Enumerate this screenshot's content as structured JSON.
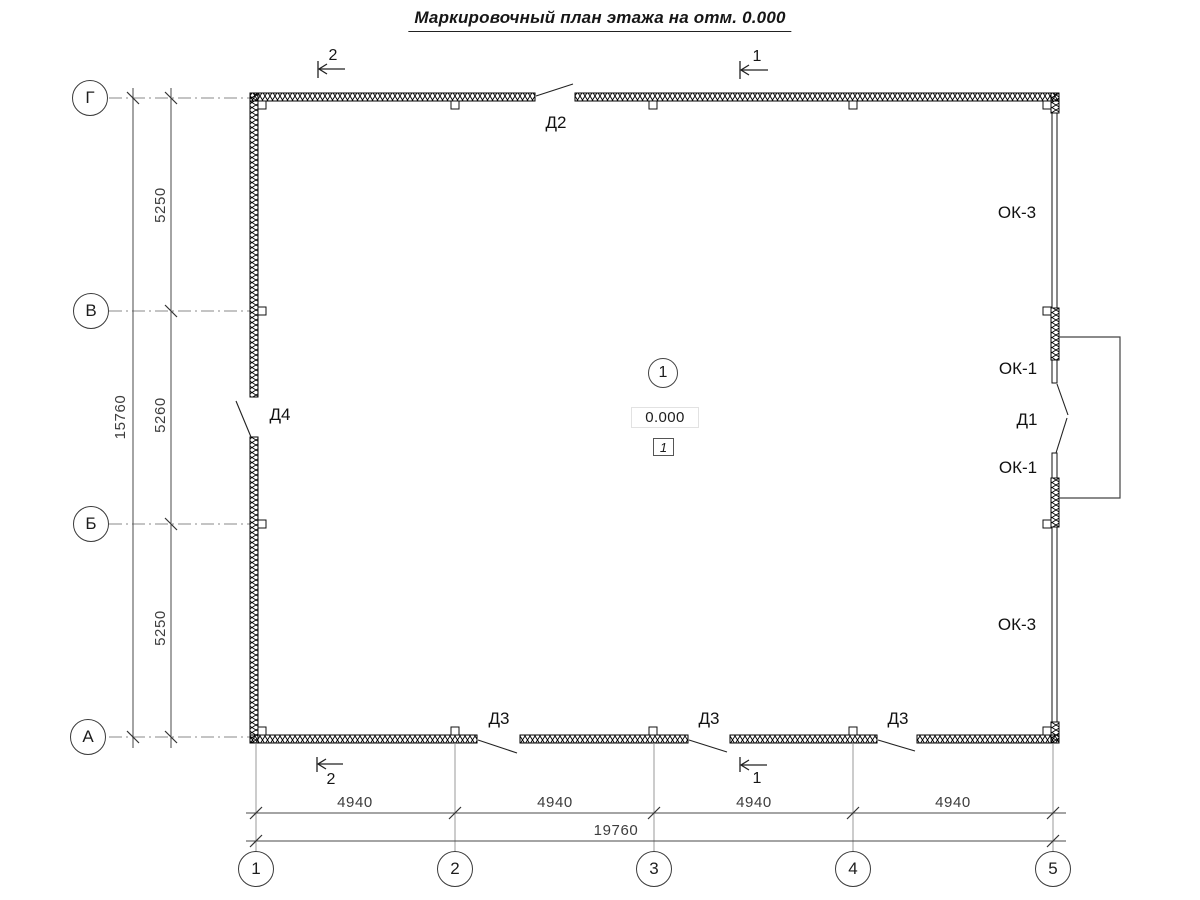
{
  "title": "Маркировочный план этажа на отм. 0.000",
  "room_marker": {
    "number": "1",
    "elevation": "0.000",
    "zone": "1"
  },
  "axes": {
    "rows": [
      {
        "label": "Г"
      },
      {
        "label": "В"
      },
      {
        "label": "Б"
      },
      {
        "label": "А"
      }
    ],
    "cols": [
      {
        "label": "1"
      },
      {
        "label": "2"
      },
      {
        "label": "3"
      },
      {
        "label": "4"
      },
      {
        "label": "5"
      }
    ]
  },
  "dimensions": {
    "vertical": {
      "segments": [
        "5250",
        "5260",
        "5250"
      ],
      "total": "15760"
    },
    "horizontal": {
      "segments": [
        "4940",
        "4940",
        "4940",
        "4940"
      ],
      "total": "19760"
    }
  },
  "marks": {
    "door_d1": "Д1",
    "door_d2": "Д2",
    "door_d3": "Д3",
    "door_d4": "Д4",
    "window_ok1": "ОК-1",
    "window_ok3": "ОК-3"
  },
  "sections": {
    "s1": "1",
    "s2": "2"
  },
  "colors": {
    "line": "#111111",
    "dim": "#4a4a4a",
    "axis": "#888888",
    "background": "#ffffff"
  }
}
